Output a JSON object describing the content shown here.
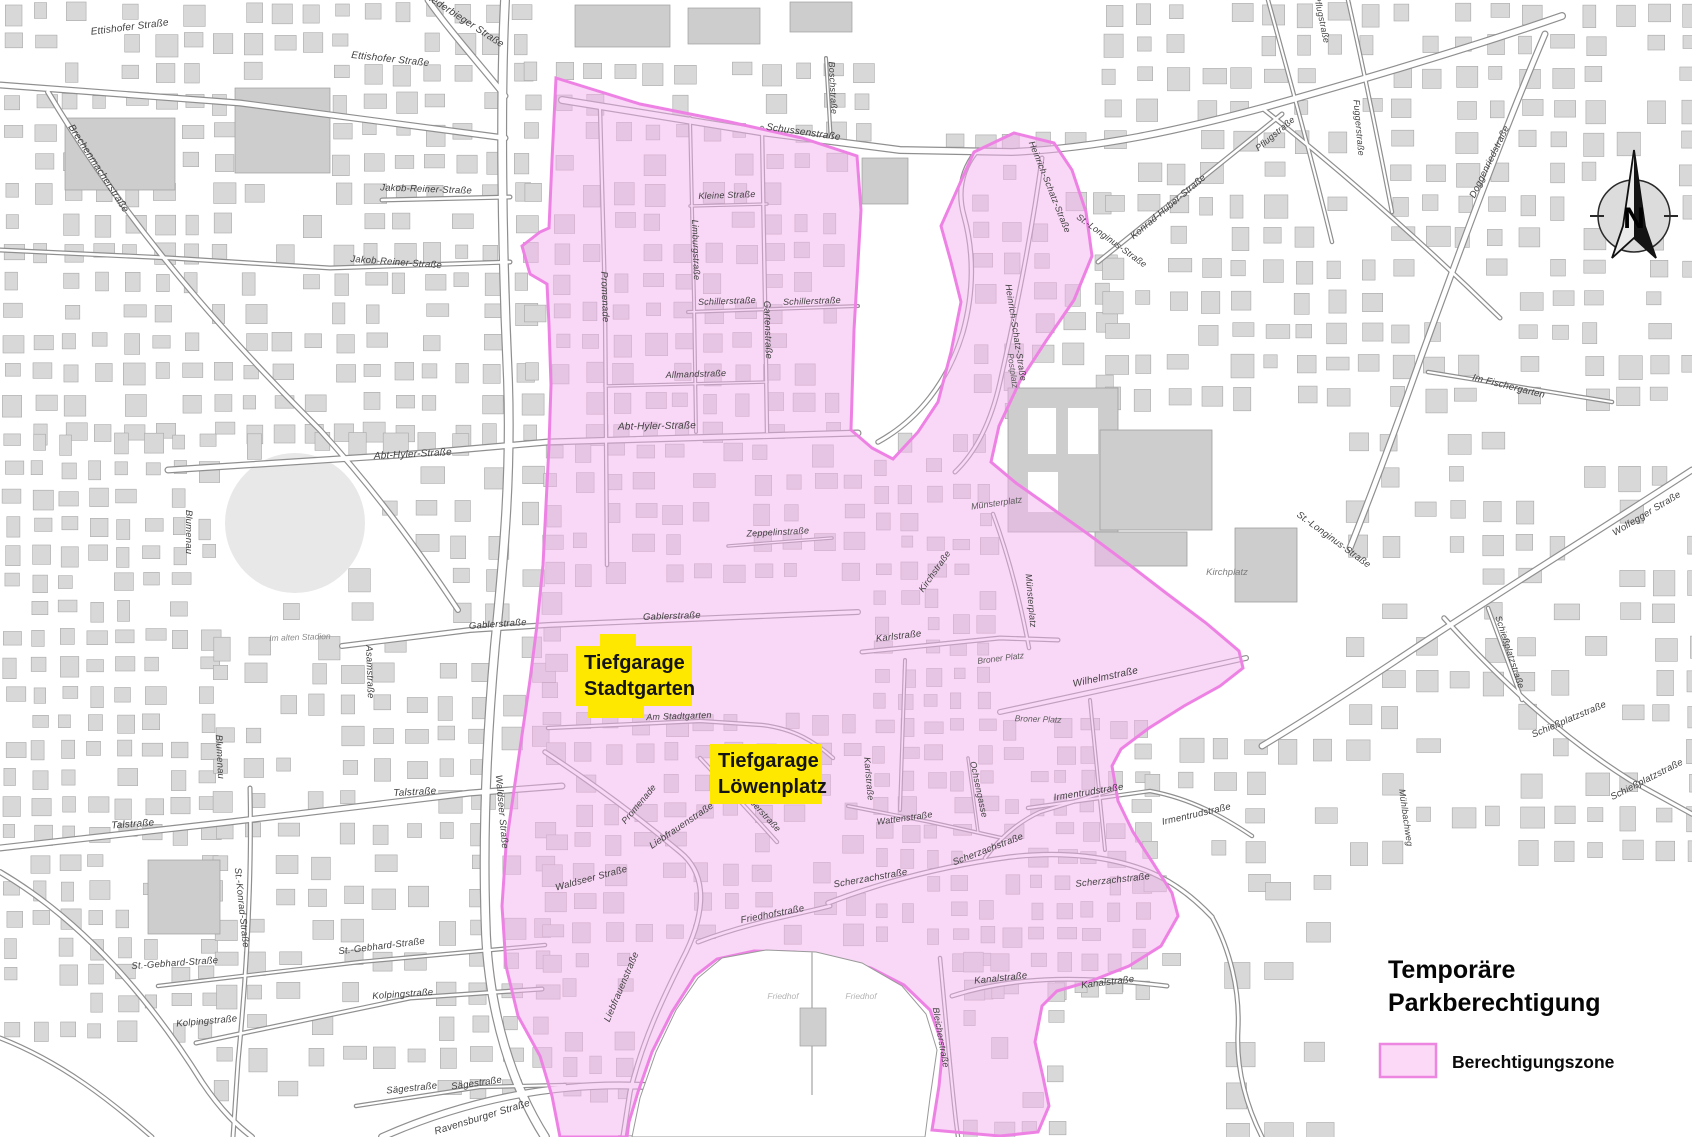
{
  "map": {
    "title": {
      "line1": "Temporäre",
      "line2": "Parkberechtigung"
    },
    "legend": {
      "label": "Berechtigungszone",
      "swatch_fill": "#fbd9f7",
      "swatch_border": "#ec86e0"
    },
    "north_label": "N",
    "colors": {
      "zone_fill": "#f4afee",
      "zone_border": "#ee82e4",
      "building_fill": "#d8d8d8",
      "building_stroke": "#a8a8a8",
      "big_building_fill": "#cdcdcd",
      "road_casing": "#8f8f8f",
      "road_fill": "#ffffff",
      "garage_highlight": "#ffe800"
    },
    "garages": [
      {
        "name": "tiefgarage-stadtgarten",
        "line1": "Tiefgarage",
        "line2": "Stadtgarten"
      },
      {
        "name": "tiefgarage-loewenplatz",
        "line1": "Tiefgarage",
        "line2": "Löwenplatz"
      }
    ],
    "street_labels": [
      {
        "t": "Ettishofer Straße",
        "x": 130,
        "y": 30,
        "r": -7,
        "s": 10
      },
      {
        "t": "Ettishofer Straße",
        "x": 390,
        "y": 62,
        "r": 6,
        "s": 10
      },
      {
        "t": "Niederbieger Straße",
        "x": 462,
        "y": 22,
        "r": 33,
        "s": 10
      },
      {
        "t": "Brechenmacherstraße",
        "x": 96,
        "y": 170,
        "r": 57,
        "s": 10
      },
      {
        "t": "Jakob-Reiner-Straße",
        "x": 426,
        "y": 192,
        "r": 2,
        "s": 9.5
      },
      {
        "t": "Jakob-Reiner-Straße",
        "x": 396,
        "y": 265,
        "r": 4,
        "s": 9.5
      },
      {
        "t": "Abt-Hyler-Straße",
        "x": 413,
        "y": 457,
        "r": -3,
        "s": 10
      },
      {
        "t": "Abt-Hyler-Straße",
        "x": 657,
        "y": 429,
        "r": -1,
        "s": 10
      },
      {
        "t": "Gablerstraße",
        "x": 498,
        "y": 627,
        "r": -4,
        "s": 9.5
      },
      {
        "t": "Gablerstraße",
        "x": 672,
        "y": 619,
        "r": -2,
        "s": 9.5
      },
      {
        "t": "Blumenau",
        "x": 186,
        "y": 532,
        "r": 90,
        "s": 9.5
      },
      {
        "t": "Blumenau",
        "x": 217,
        "y": 757,
        "r": 87,
        "s": 9.5
      },
      {
        "t": "Asamstraße",
        "x": 367,
        "y": 672,
        "r": 88,
        "s": 9.5
      },
      {
        "t": "Talstraße",
        "x": 133,
        "y": 827,
        "r": -4,
        "s": 10
      },
      {
        "t": "Talstraße",
        "x": 415,
        "y": 795,
        "r": -3,
        "s": 10
      },
      {
        "t": "St.-Konrad-Straße",
        "x": 239,
        "y": 908,
        "r": 84,
        "s": 9.5
      },
      {
        "t": "St.-Gebhard-Straße",
        "x": 175,
        "y": 966,
        "r": -4,
        "s": 9.5
      },
      {
        "t": "St.-Gebhard-Straße",
        "x": 382,
        "y": 949,
        "r": -7,
        "s": 9.5
      },
      {
        "t": "Kolpingstraße",
        "x": 207,
        "y": 1024,
        "r": -5,
        "s": 9.5
      },
      {
        "t": "Kolpingstraße",
        "x": 403,
        "y": 997,
        "r": -4,
        "s": 9.5
      },
      {
        "t": "Sägestraße",
        "x": 412,
        "y": 1091,
        "r": -6,
        "s": 9.5
      },
      {
        "t": "Sägestraße",
        "x": 477,
        "y": 1086,
        "r": -8,
        "s": 9.5
      },
      {
        "t": "Ravensburger Straße",
        "x": 483,
        "y": 1120,
        "r": -17,
        "s": 10
      },
      {
        "t": "Waldseer Straße",
        "x": 592,
        "y": 881,
        "r": -15,
        "s": 9.5
      },
      {
        "t": "Waldseer Straße",
        "x": 499,
        "y": 812,
        "r": 85,
        "s": 9.5
      },
      {
        "t": "Schussenstraße",
        "x": 803,
        "y": 135,
        "r": 8,
        "s": 10
      },
      {
        "t": "Boschstraße",
        "x": 830,
        "y": 88,
        "r": 87,
        "s": 9
      },
      {
        "t": "Promenade",
        "x": 602,
        "y": 297,
        "r": 88,
        "s": 9.5
      },
      {
        "t": "Promenade",
        "x": 641,
        "y": 806,
        "r": -50,
        "s": 9
      },
      {
        "t": "Kleine Straße",
        "x": 727,
        "y": 198,
        "r": -2,
        "s": 9
      },
      {
        "t": "Schillerstraße",
        "x": 727,
        "y": 304,
        "r": -2,
        "s": 9
      },
      {
        "t": "Schillerstraße",
        "x": 812,
        "y": 304,
        "r": -2,
        "s": 9
      },
      {
        "t": "Allmandstraße",
        "x": 696,
        "y": 377,
        "r": -2,
        "s": 9
      },
      {
        "t": "Gartenstraße",
        "x": 765,
        "y": 330,
        "r": 88,
        "s": 9.5
      },
      {
        "t": "Limburgstraße",
        "x": 693,
        "y": 250,
        "r": 88,
        "s": 9
      },
      {
        "t": "Am Stadtgarten",
        "x": 679,
        "y": 719,
        "r": -2,
        "s": 9
      },
      {
        "t": "Heinrich-Schatz-Straße",
        "x": 1047,
        "y": 188,
        "r": 68,
        "s": 9
      },
      {
        "t": "Heinrich-Schatz-Straße",
        "x": 1013,
        "y": 333,
        "r": 81,
        "s": 9
      },
      {
        "t": "St.-Longinus-Straße",
        "x": 1110,
        "y": 243,
        "r": 36,
        "s": 9
      },
      {
        "t": "St.-Longinus-Straße",
        "x": 1332,
        "y": 542,
        "r": 36,
        "s": 9.5
      },
      {
        "t": "Münsterplatz",
        "x": 1028,
        "y": 601,
        "r": 85,
        "s": 9
      },
      {
        "t": "Kirchstraße",
        "x": 937,
        "y": 573,
        "r": -55,
        "s": 9
      },
      {
        "t": "Karlstraße",
        "x": 899,
        "y": 639,
        "r": -7,
        "s": 9.5
      },
      {
        "t": "Karlstraße",
        "x": 866,
        "y": 779,
        "r": 85,
        "s": 9
      },
      {
        "t": "Zeppelinstraße",
        "x": 778,
        "y": 535,
        "r": -3,
        "s": 9
      },
      {
        "t": "Wilhelmstraße",
        "x": 1106,
        "y": 680,
        "r": -12,
        "s": 10
      },
      {
        "t": "Irmentrudstraße",
        "x": 1089,
        "y": 795,
        "r": -9,
        "s": 9.5
      },
      {
        "t": "Irmentrudstraße",
        "x": 1197,
        "y": 817,
        "r": -13,
        "s": 9.5
      },
      {
        "t": "Ochsengasse",
        "x": 976,
        "y": 790,
        "r": 78,
        "s": 9
      },
      {
        "t": "Wattenstraße",
        "x": 905,
        "y": 821,
        "r": -8,
        "s": 9
      },
      {
        "t": "Friedhofstraße",
        "x": 773,
        "y": 917,
        "r": -11,
        "s": 9.5
      },
      {
        "t": "Scherzachstraße",
        "x": 871,
        "y": 881,
        "r": -10,
        "s": 9.5
      },
      {
        "t": "Scherzachstraße",
        "x": 989,
        "y": 852,
        "r": -21,
        "s": 9.5
      },
      {
        "t": "Scherzachstraße",
        "x": 1113,
        "y": 883,
        "r": -6,
        "s": 9.5
      },
      {
        "t": "Kanalstraße",
        "x": 1001,
        "y": 981,
        "r": -6,
        "s": 9.5
      },
      {
        "t": "Kanalstraße",
        "x": 1108,
        "y": 985,
        "r": -7,
        "s": 9.5
      },
      {
        "t": "Bleicherstraße",
        "x": 938,
        "y": 1038,
        "r": 80,
        "s": 9
      },
      {
        "t": "Liebfrauenstraße",
        "x": 683,
        "y": 828,
        "r": -34,
        "s": 9.5
      },
      {
        "t": "Liebfrauenstraße",
        "x": 624,
        "y": 988,
        "r": -67,
        "s": 9.5
      },
      {
        "t": "Gerberstraße",
        "x": 758,
        "y": 812,
        "r": 47,
        "s": 9
      },
      {
        "t": "Doggenriedstraße",
        "x": 1492,
        "y": 163,
        "r": -64,
        "s": 9.5
      },
      {
        "t": "Konrad-Huber-Straße",
        "x": 1170,
        "y": 209,
        "r": -40,
        "s": 9.5
      },
      {
        "t": "Pflugstraße",
        "x": 1277,
        "y": 136,
        "r": -40,
        "s": 9
      },
      {
        "t": "Pflugstraße",
        "x": 1319,
        "y": 20,
        "r": 78,
        "s": 9
      },
      {
        "t": "Fuggerstraße",
        "x": 1356,
        "y": 128,
        "r": 85,
        "s": 9
      },
      {
        "t": "Im Fischergarten",
        "x": 1508,
        "y": 389,
        "r": 14,
        "s": 9.5
      },
      {
        "t": "Wolfegger Straße",
        "x": 1648,
        "y": 516,
        "r": -31,
        "s": 9.5
      },
      {
        "t": "Schießplatzstraße",
        "x": 1507,
        "y": 653,
        "r": 72,
        "s": 9
      },
      {
        "t": "Schießplatzstraße",
        "x": 1570,
        "y": 722,
        "r": -23,
        "s": 9.5
      },
      {
        "t": "Schießplatzstraße",
        "x": 1648,
        "y": 782,
        "r": -27,
        "s": 9.5
      },
      {
        "t": "Mühlbachweg",
        "x": 1403,
        "y": 818,
        "r": 82,
        "s": 9
      }
    ],
    "place_labels": [
      {
        "t": "Kirchplatz",
        "x": 1227,
        "y": 575,
        "r": 0,
        "s": 9.5,
        "c": "#7d7d7d"
      },
      {
        "t": "Münsterplatz",
        "x": 997,
        "y": 506,
        "r": -8,
        "s": 9,
        "c": "#5c5c5c"
      },
      {
        "t": "Broner Platz",
        "x": 1001,
        "y": 661,
        "r": -7,
        "s": 8.5,
        "c": "#5c5c5c"
      },
      {
        "t": "Broner Platz",
        "x": 1038,
        "y": 722,
        "r": 2,
        "s": 8.5,
        "c": "#5c5c5c"
      },
      {
        "t": "Im alten Stadion",
        "x": 300,
        "y": 640,
        "r": -2,
        "s": 8.5,
        "c": "#8c8c8c"
      },
      {
        "t": "Friedhof",
        "x": 783,
        "y": 999,
        "r": 0,
        "s": 8.5,
        "c": "#b5b5b5"
      },
      {
        "t": "Friedhof",
        "x": 861,
        "y": 999,
        "r": 0,
        "s": 8.5,
        "c": "#b5b5b5"
      },
      {
        "t": "Postplatz",
        "x": 1010,
        "y": 371,
        "r": 82,
        "s": 8.5,
        "c": "#5c5c5c"
      }
    ]
  }
}
